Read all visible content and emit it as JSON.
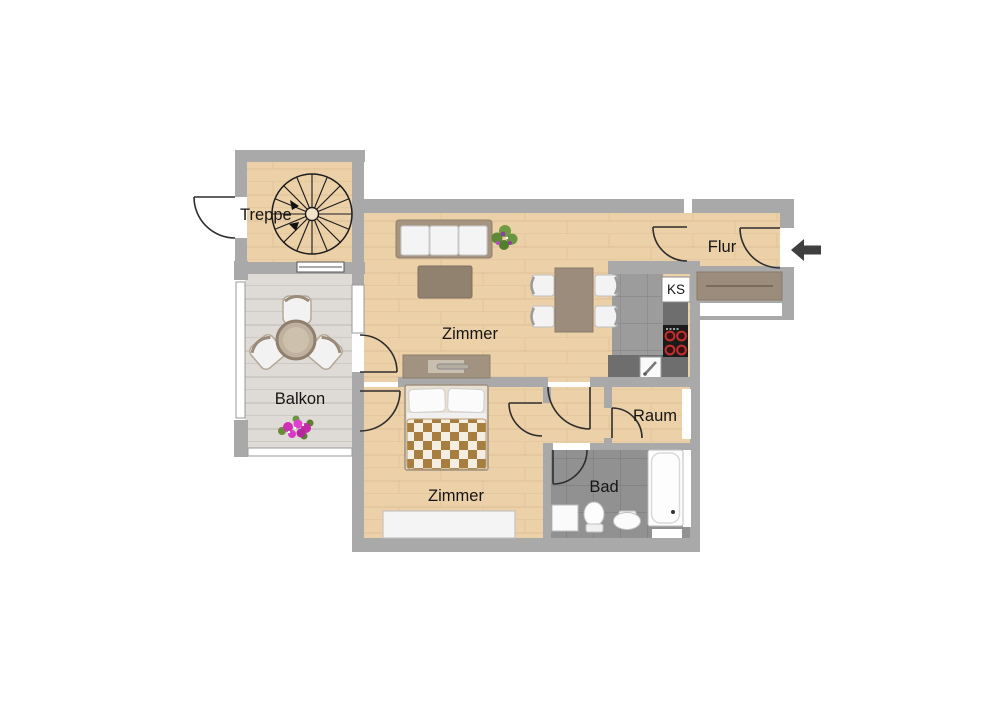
{
  "plan": {
    "type": "floorplan",
    "labels": {
      "treppe": "Treppe",
      "zimmer_living": "Zimmer",
      "flur": "Flur",
      "balkon": "Balkon",
      "zimmer_bedroom": "Zimmer",
      "raum": "Raum",
      "bad": "Bad",
      "fridge": "KS"
    },
    "colors": {
      "wall": "#a9a9a9",
      "wood_floor": "#ecd0a8",
      "balcony_deck": "#dedad6",
      "kitchen_tile": "#9c9c9c",
      "counter": "#6e6e6e",
      "furniture_brown": "#9c8c7b",
      "door_line": "#2e2e2e",
      "burner_red": "#c03030",
      "flower_pink": "#d633b8",
      "plant_green": "#5c8a35",
      "arrow": "#3f3f3f",
      "text": "#151515"
    }
  }
}
